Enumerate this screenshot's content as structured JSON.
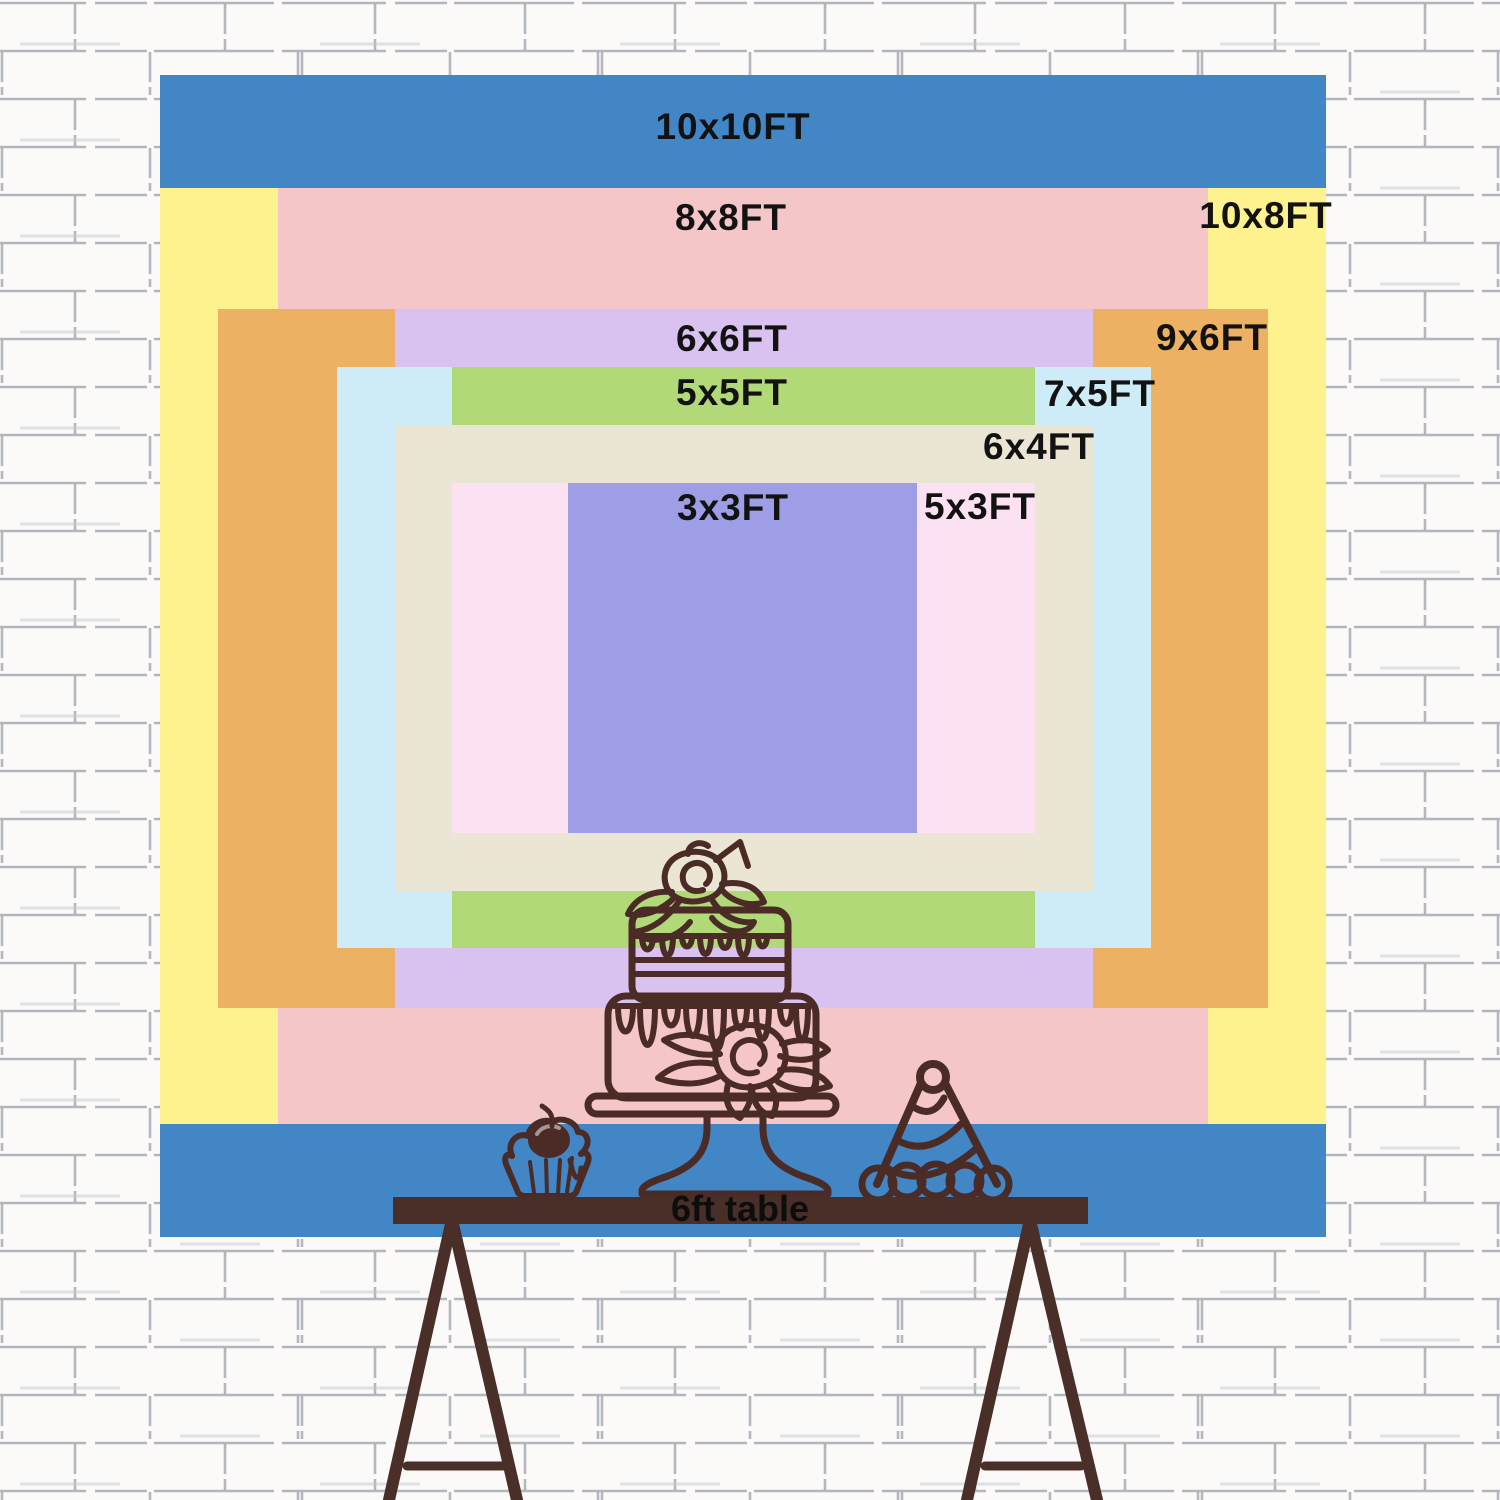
{
  "sizes": [
    {
      "id": "10x10",
      "label": "10x10FT",
      "color": "#4286c5"
    },
    {
      "id": "10x8",
      "label": "10x8FT",
      "color": "#fdf28e"
    },
    {
      "id": "8x8",
      "label": "8x8FT",
      "color": "#f4c6c8"
    },
    {
      "id": "9x6",
      "label": "9x6FT",
      "color": "#ecb162"
    },
    {
      "id": "6x6",
      "label": "6x6FT",
      "color": "#d9c2ef"
    },
    {
      "id": "7x5",
      "label": "7x5FT",
      "color": "#cdecf8"
    },
    {
      "id": "5x5",
      "label": "5x5FT",
      "color": "#b1d977"
    },
    {
      "id": "6x4",
      "label": "6x4FT",
      "color": "#ebe5d4"
    },
    {
      "id": "5x3",
      "label": "5x3FT",
      "color": "#fce1f2"
    },
    {
      "id": "3x3",
      "label": "3x3FT",
      "color": "#9d9ee5"
    }
  ],
  "table": {
    "label": "6ft table",
    "color": "#4a2e28"
  },
  "icons": {
    "cake": "tiered-cake-icon",
    "cupcake": "cupcake-icon",
    "party_hat": "party-hat-icon"
  },
  "line_art_color": "#4a2b26",
  "label_text_color": "#121212",
  "background": "white-brick-wall"
}
